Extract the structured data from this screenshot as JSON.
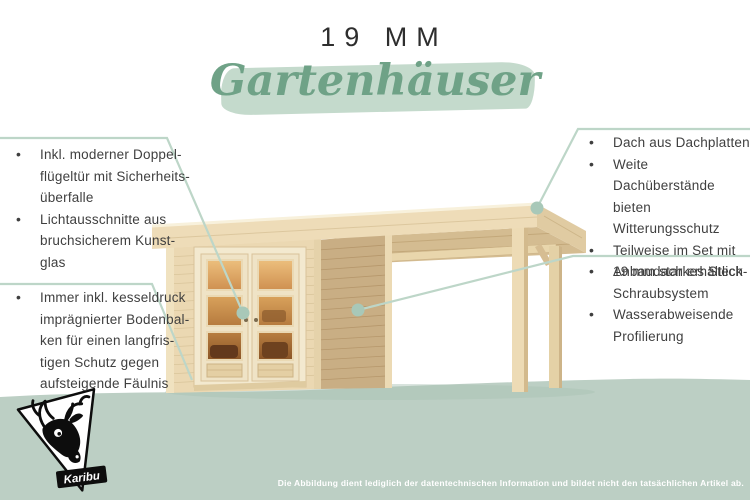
{
  "header": {
    "title": "19 MM",
    "subtitle": "Gartenhäuser"
  },
  "ui": {
    "bullet": "•"
  },
  "callouts": {
    "left_top": {
      "items": [
        {
          "text": "Inkl. moderner Doppel-\nflügeltür mit Sicherheits-\nüberfalle"
        },
        {
          "text": "Lichtausschnitte aus\nbruchsicherem Kunst-\nglas"
        }
      ]
    },
    "left_bottom": {
      "items": [
        {
          "text": "Immer inkl. kesseldruck\nimprägnierter Bodenbal-\nken für einen langfris-\ntigen Schutz gegen\naufsteigende Fäulnis"
        }
      ]
    },
    "right_top": {
      "items": [
        {
          "text": "Dach aus Dachplatten"
        },
        {
          "text": "Weite Dachüberstände\nbieten Witterungsschutz"
        },
        {
          "text": "Teilweise im Set mit\nAnbaudach erhältlich"
        }
      ]
    },
    "right_bottom": {
      "items": [
        {
          "text": "19 mm starkes Steck-\nSchraubsystem"
        },
        {
          "text": "Wasserabweisende\nProfilierung"
        }
      ]
    }
  },
  "footer": {
    "disclaimer": "Die Abbildung dient lediglich der datentechnischen Information und bildet nicht den tatsächlichen Artikel ab."
  },
  "logo": {
    "label": "Karibu"
  },
  "colors": {
    "script_green": "#6fa287",
    "brush_green": "#c4dacc",
    "ground_green": "#bccfc4",
    "callout_line": "#bdd6c8",
    "callout_dot": "#a8c8b8",
    "text_dark": "#3f3f3f",
    "wood_light": "#ebd8b2",
    "wood_mid": "#c9ae84",
    "wood_cream": "#f3e9cf",
    "glass_warm": "#dfa660",
    "disclaimer_text": "#ffffff"
  }
}
